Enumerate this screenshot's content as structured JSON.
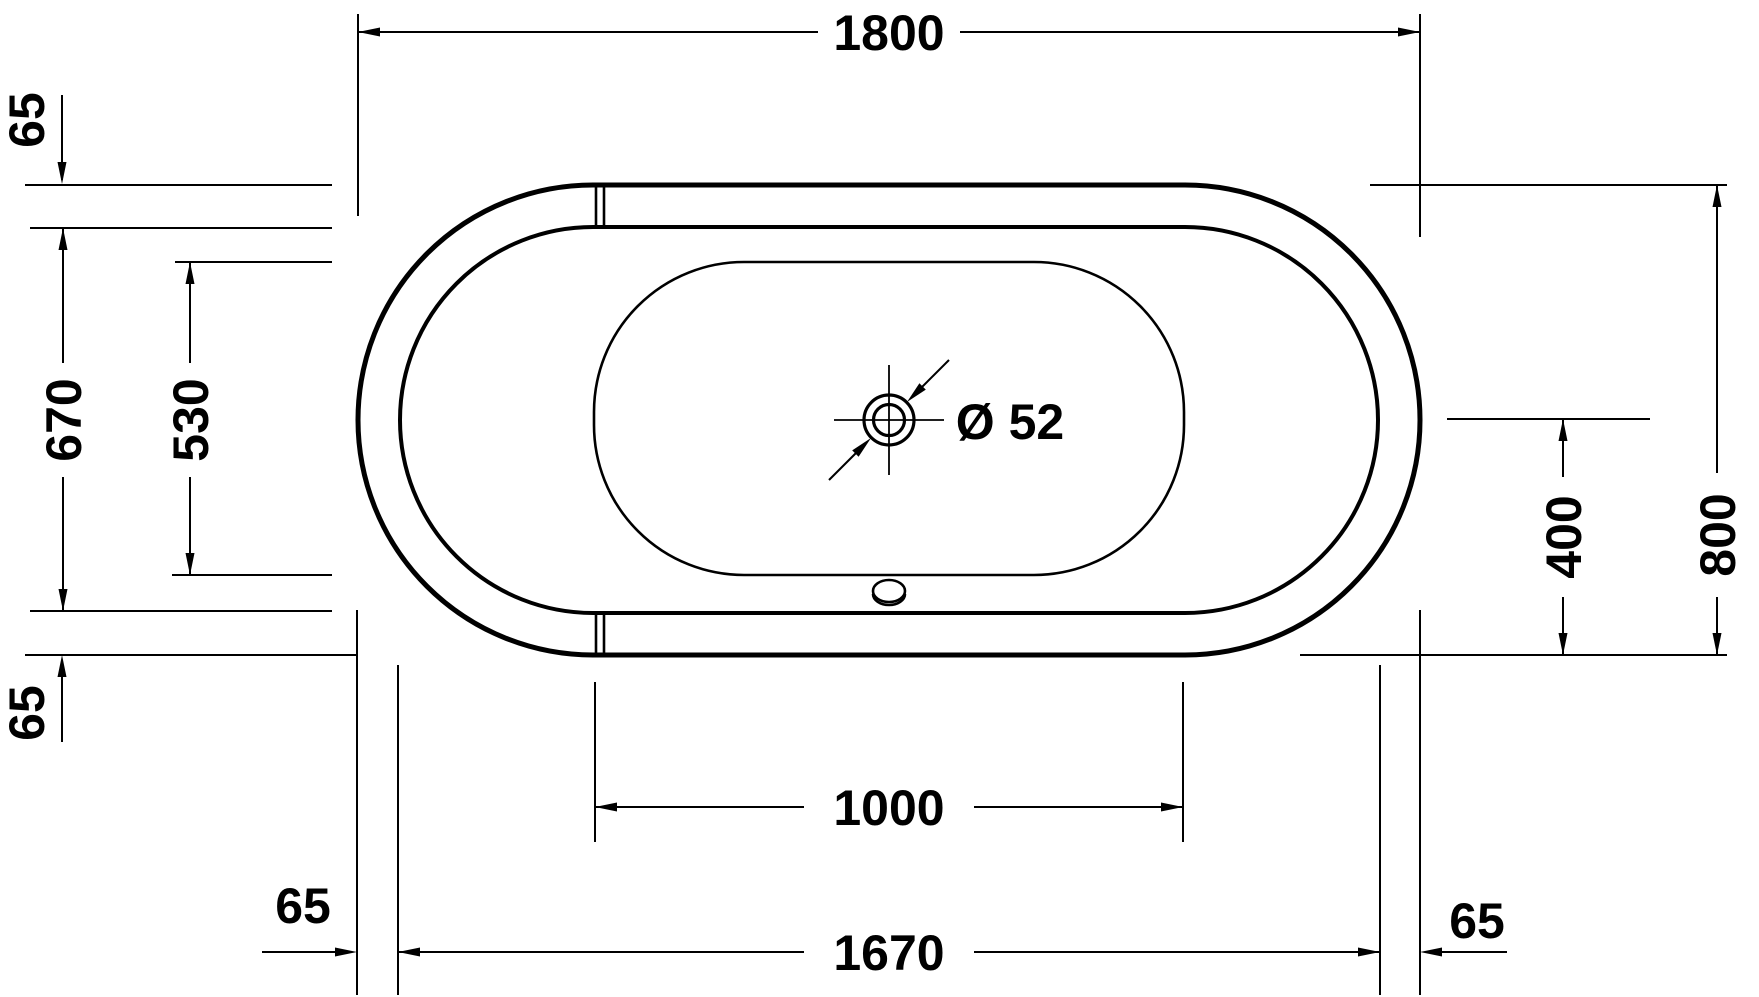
{
  "drawing": {
    "type": "technical-plan-top-view",
    "subject": "oval bathtub with center drain",
    "background_color": "#ffffff",
    "line_color": "#000000",
    "unit_system": "mm",
    "dimensions": {
      "overall_length": "1800",
      "overall_width": "800",
      "rim_offset_top_left": "65",
      "rim_offset_bottom_left": "65",
      "rim_offset_left_end": "65",
      "rim_offset_right_end": "65",
      "inner_opening_width": "670",
      "basin_floor_width": "530",
      "basin_floor_length": "1000",
      "inner_opening_length": "1670",
      "drain_center_from_bottom_edge": "400",
      "drain_diameter_label": "Ø 52"
    }
  }
}
